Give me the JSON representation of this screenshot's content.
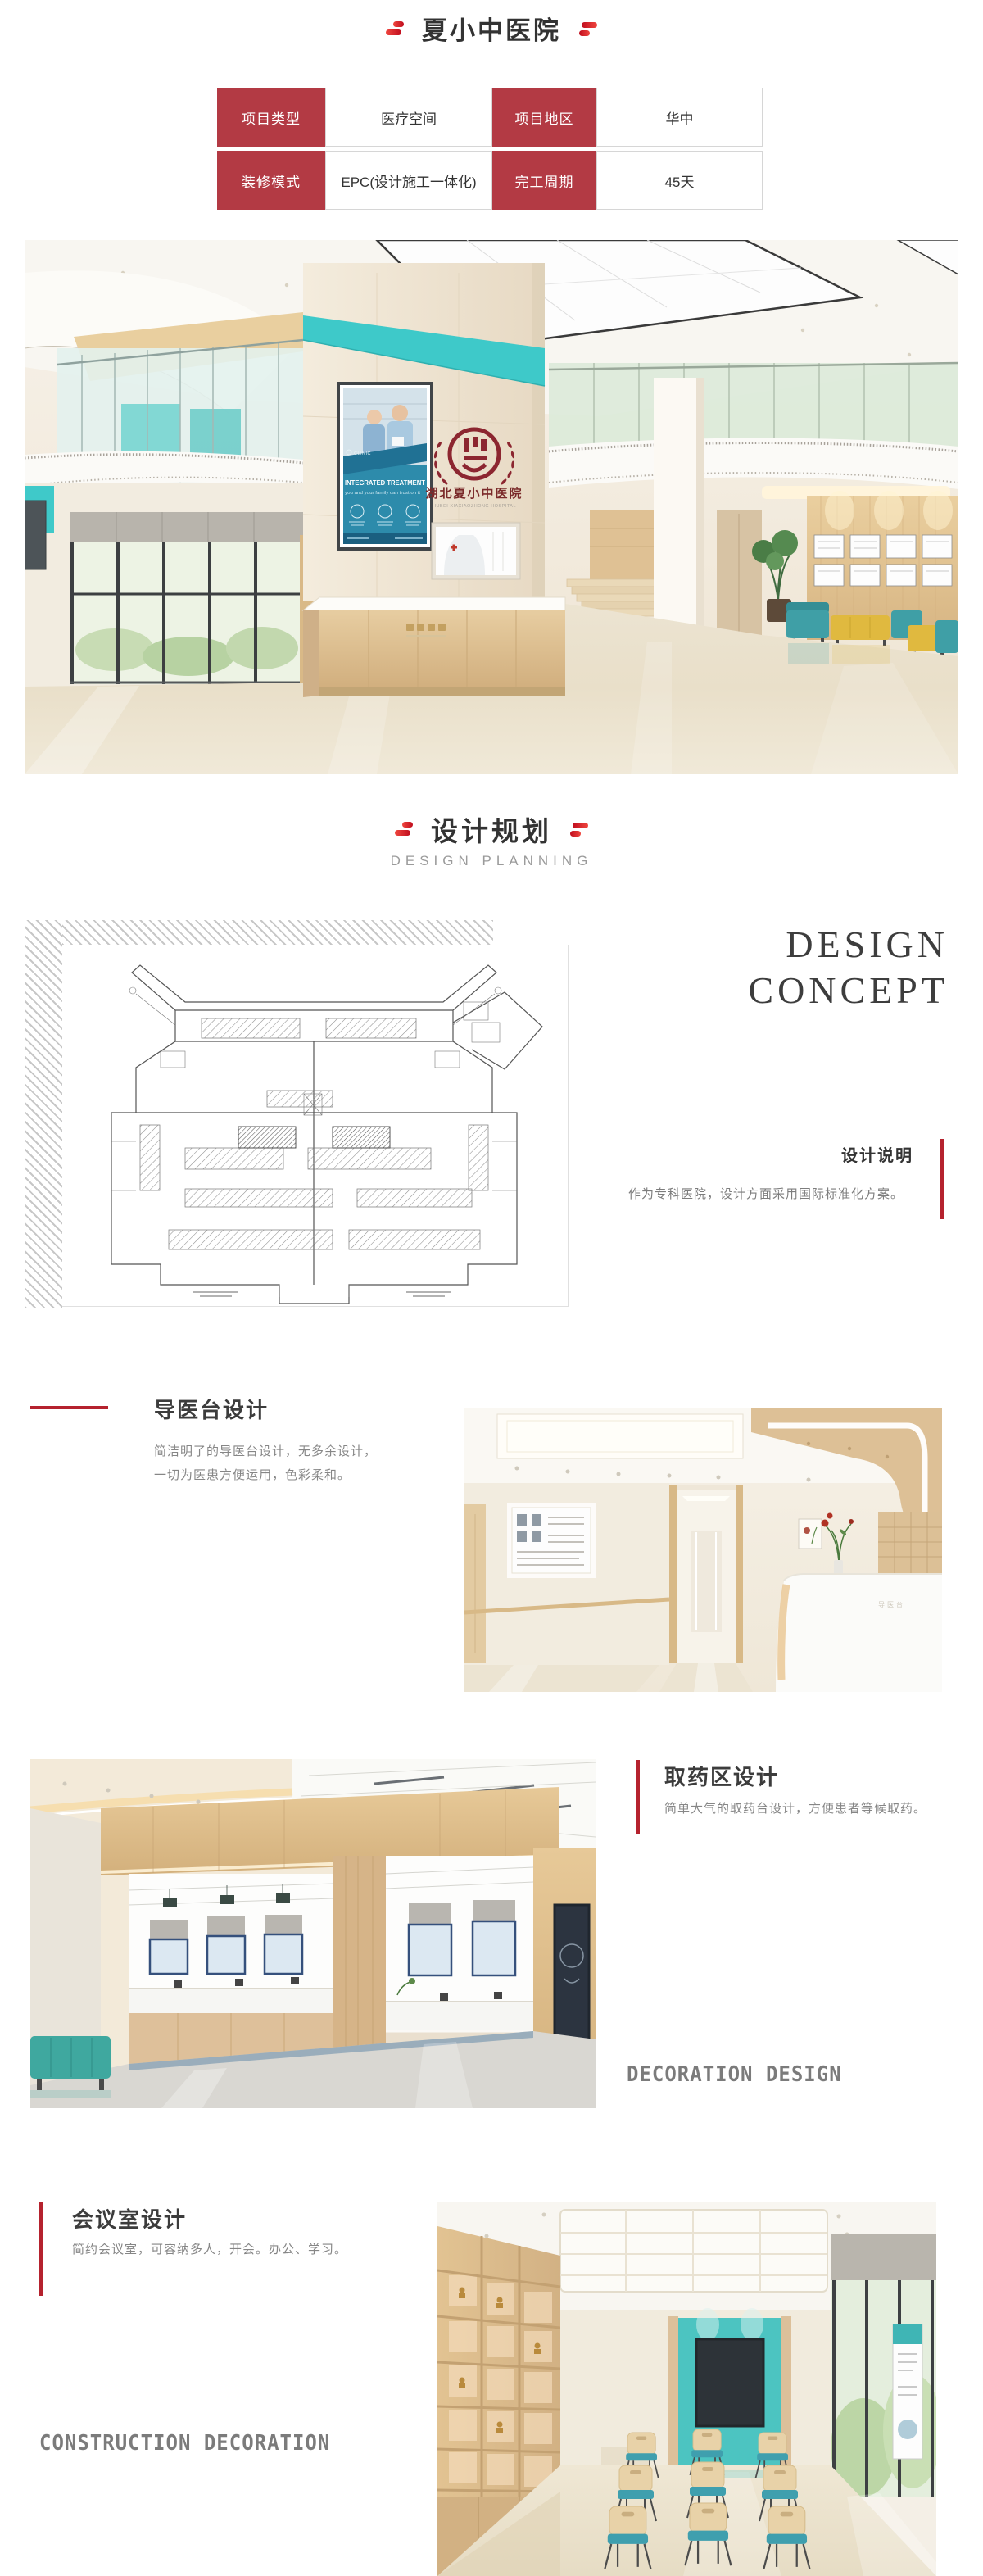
{
  "colors": {
    "table_red": "#b33a44",
    "accent_red": "#b5222e",
    "teal": "#3fc9c9"
  },
  "header": {
    "title": "夏小中医院"
  },
  "info_table": {
    "rows": [
      [
        "项目类型",
        "医疗空间",
        "项目地区",
        "华中"
      ],
      [
        "装修模式",
        "EPC(设计施工一体化)",
        "完工周期",
        "45天"
      ]
    ]
  },
  "hero": {
    "poster": {
      "brand": "CLINIC",
      "title": "INTEGRATED TREATMENT",
      "subtitle": "you and your family can trust on it"
    },
    "logo": {
      "name_cn": "湖北夏小中医院",
      "name_en": "HUBEI XIAXIAOZHONG HOSPITAL"
    }
  },
  "planning": {
    "title": "设计规划",
    "subtitle": "DESIGN PLANNING"
  },
  "concept": {
    "en_line1": "DESIGN",
    "en_line2": "CONCEPT",
    "heading": "设计说明",
    "desc": "作为专科医院，设计方面采用国际标准化方案。"
  },
  "guide": {
    "heading": "导医台设计",
    "desc1": "简洁明了的导医台设计，无多余设计，",
    "desc2": "一切为医患方便运用，色彩柔和。",
    "desk_label": "导医台"
  },
  "pharmacy": {
    "heading": "取药区设计",
    "desc": "简单大气的取药台设计，方便患者等候取药。",
    "wall_label": "中药制作",
    "watermark": "DECORATION DESIGN"
  },
  "meeting": {
    "heading": "会议室设计",
    "desc": "简约会议室，可容纳多人，开会。办公、学习。",
    "watermark": "CONSTRUCTION DECORATION"
  }
}
